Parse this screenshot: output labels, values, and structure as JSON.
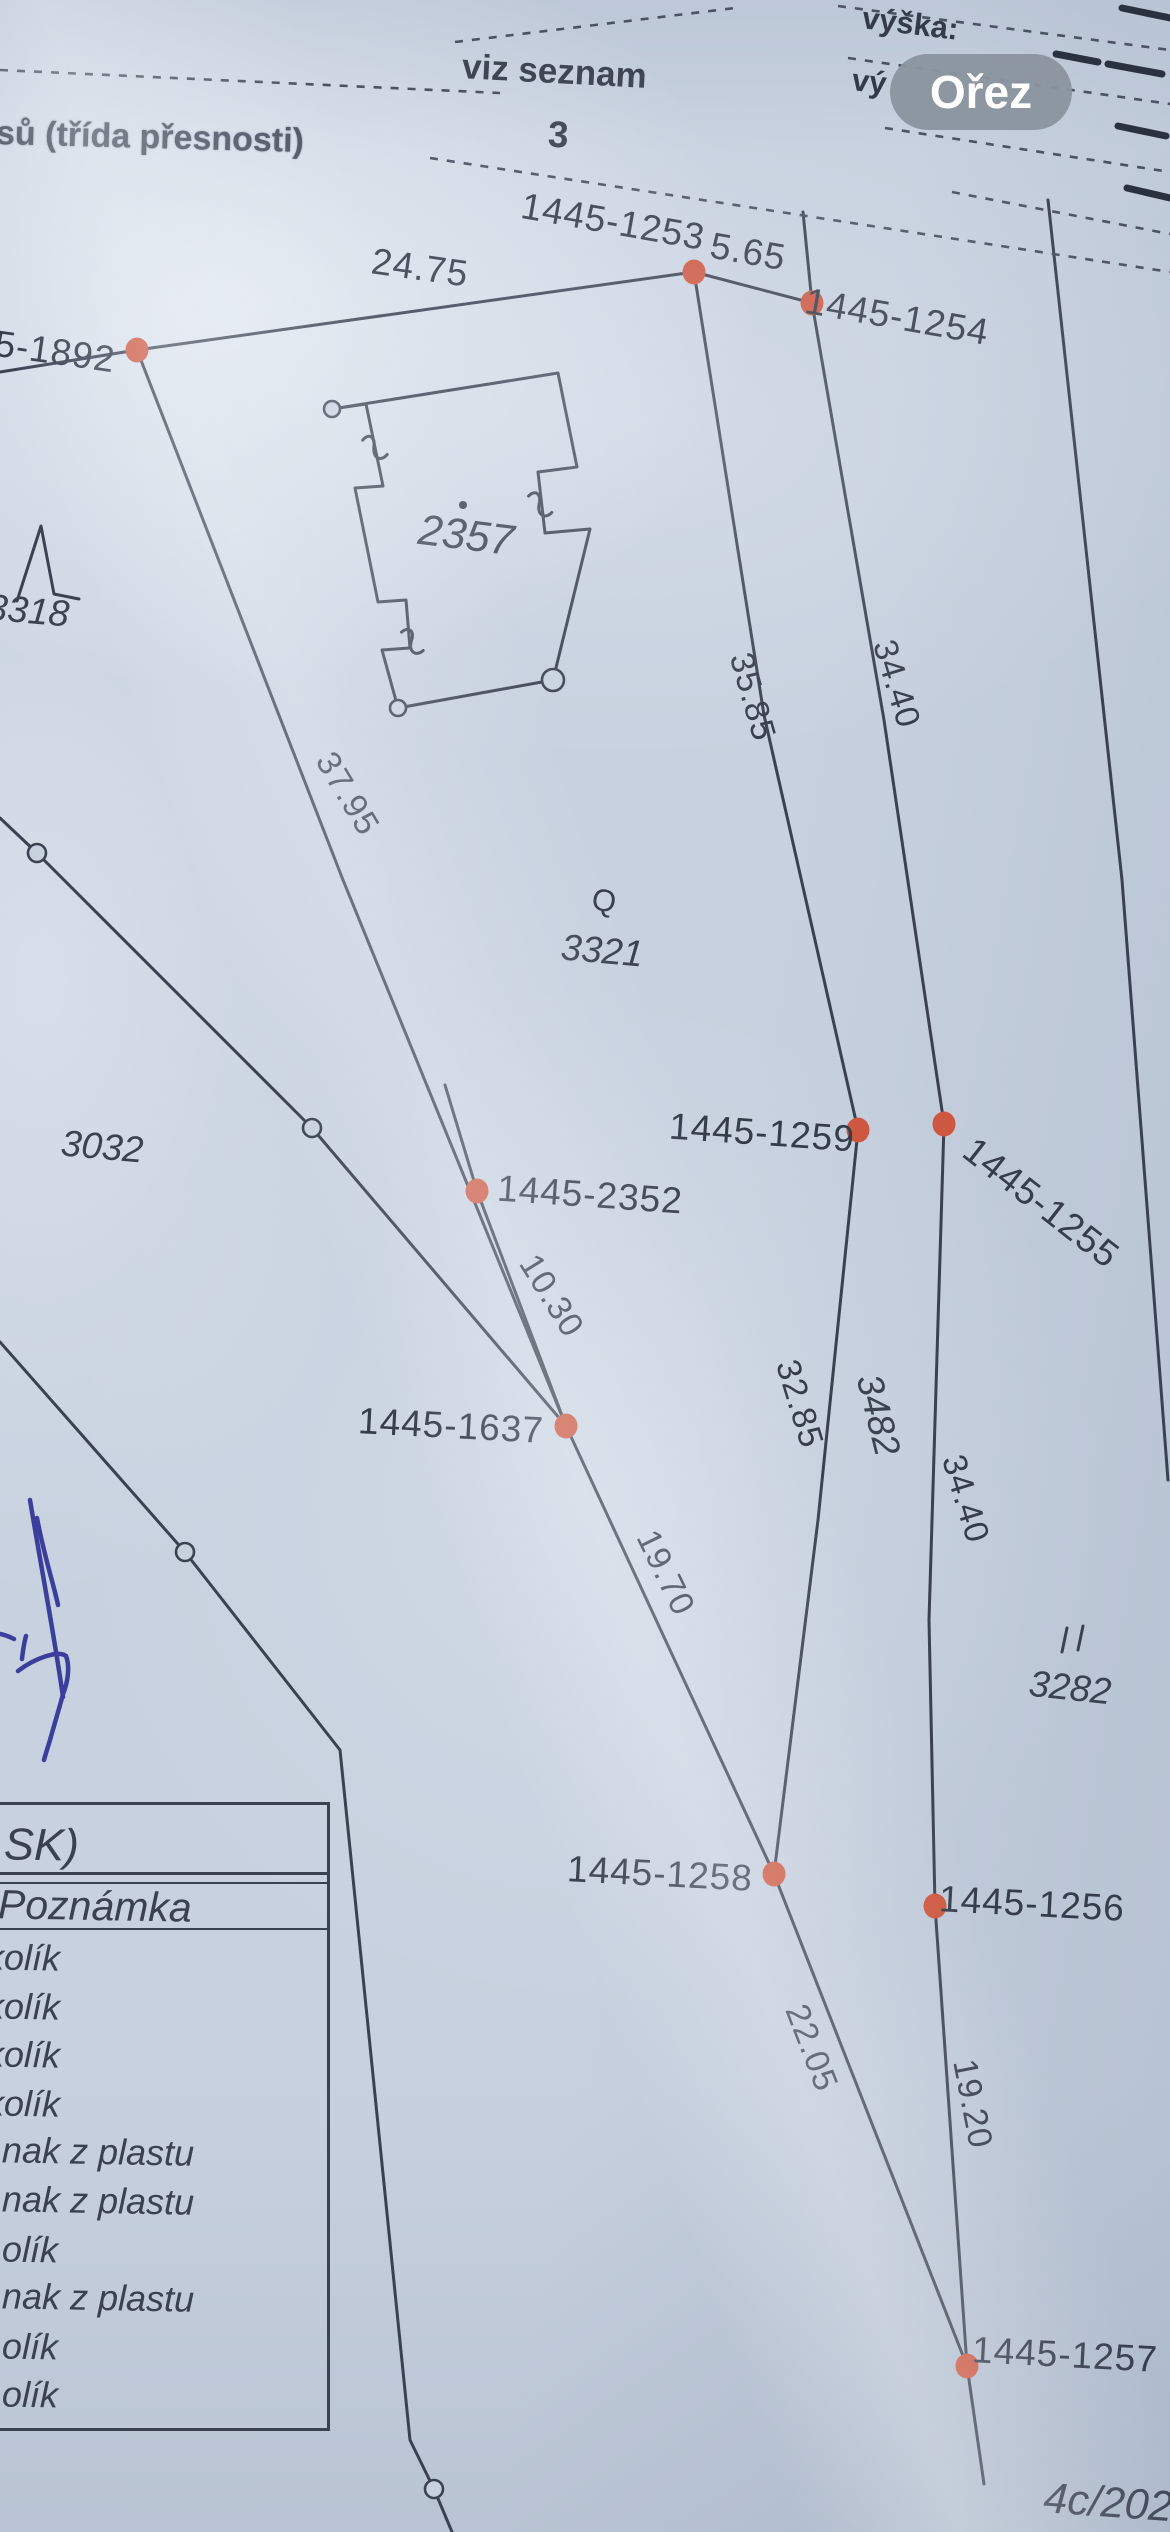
{
  "ui": {
    "crop_button_label": "Ořez"
  },
  "header": {
    "accuracy_note": "sů (třída přesnosti)",
    "see_list": "viz seznam",
    "list_number": "3",
    "height_label": "výška:",
    "height_label_partial": "vý"
  },
  "legend_table": {
    "header_fragment": "SK)",
    "subheader": "Poznámka",
    "rows": [
      "kolík",
      "kolík",
      "kolík",
      "kolík",
      "nak z plastu",
      "nak z plastu",
      "olík",
      "nak z plastu",
      "olík",
      "olík"
    ]
  },
  "colors": {
    "paper": "#c7d1df",
    "ink": "#3a4150",
    "point": "#cd5740",
    "button_bg": "#8a949e",
    "handwriting_ink": "#3c3e9b"
  },
  "map": {
    "points": [
      {
        "id": "1445-1253",
        "x": 694,
        "y": 272
      },
      {
        "id": "1445-1254",
        "x": 812,
        "y": 303
      },
      {
        "id": "1445-1892",
        "x": 137,
        "y": 350
      },
      {
        "id": "1445-1259",
        "x": 858,
        "y": 1130
      },
      {
        "id": "1445-1255",
        "x": 944,
        "y": 1124
      },
      {
        "id": "1445-2352",
        "x": 477,
        "y": 1191
      },
      {
        "id": "1445-1637",
        "x": 566,
        "y": 1426
      },
      {
        "id": "1445-1258",
        "x": 774,
        "y": 1874
      },
      {
        "id": "1445-1256",
        "x": 935,
        "y": 1906
      },
      {
        "id": "1445-1257",
        "x": 967,
        "y": 2366
      }
    ],
    "labels": [
      {
        "text": "1445-1253",
        "x": 613,
        "y": 222,
        "rot": 10,
        "cls": "plain"
      },
      {
        "text": "5.65",
        "x": 748,
        "y": 252,
        "rot": 10,
        "cls": "plain"
      },
      {
        "text": "1445-1254",
        "x": 897,
        "y": 317,
        "rot": 10,
        "cls": "plain"
      },
      {
        "text": "5-1892",
        "x": 55,
        "y": 352,
        "rot": 8,
        "cls": "plain"
      },
      {
        "text": "24.75",
        "x": 420,
        "y": 268,
        "rot": 8,
        "cls": "plain"
      },
      {
        "text": "1445-1259",
        "x": 762,
        "y": 1133,
        "rot": 4,
        "cls": "plain"
      },
      {
        "text": "1445-2352",
        "x": 590,
        "y": 1195,
        "rot": 4,
        "cls": "plain"
      },
      {
        "text": "1445-1637",
        "x": 451,
        "y": 1426,
        "rot": 3,
        "cls": "plain"
      },
      {
        "text": "1445-1258",
        "x": 660,
        "y": 1874,
        "rot": 3,
        "cls": "plain"
      },
      {
        "text": "1445-1256",
        "x": 1032,
        "y": 1904,
        "rot": 3,
        "cls": "plain"
      },
      {
        "text": "1445-1257",
        "x": 1065,
        "y": 2355,
        "rot": 3,
        "cls": "plain"
      },
      {
        "text": "1445-1255",
        "x": 1041,
        "y": 1203,
        "rot": 38,
        "cls": "plain"
      },
      {
        "text": "35.85",
        "x": 752,
        "y": 697,
        "rot": 74,
        "cls": "meas"
      },
      {
        "text": "34.40",
        "x": 896,
        "y": 684,
        "rot": 73,
        "cls": "meas"
      },
      {
        "text": "37.95",
        "x": 347,
        "y": 794,
        "rot": 59,
        "cls": "meas"
      },
      {
        "text": "10.30",
        "x": 551,
        "y": 1296,
        "rot": 58,
        "cls": "meas"
      },
      {
        "text": "32.85",
        "x": 799,
        "y": 1404,
        "rot": 73,
        "cls": "meas"
      },
      {
        "text": "3482",
        "x": 878,
        "y": 1415,
        "rot": 76,
        "cls": "parcel"
      },
      {
        "text": "34.40",
        "x": 965,
        "y": 1499,
        "rot": 73,
        "cls": "meas"
      },
      {
        "text": "19.70",
        "x": 665,
        "y": 1573,
        "rot": 64,
        "cls": "meas"
      },
      {
        "text": "22.05",
        "x": 811,
        "y": 2048,
        "rot": 69,
        "cls": "meas"
      },
      {
        "text": "19.20",
        "x": 972,
        "y": 2104,
        "rot": 79,
        "cls": "meas"
      },
      {
        "text": "2357",
        "x": 466,
        "y": 536,
        "rot": 7,
        "cls": "parcel-lg"
      },
      {
        "text": "3321",
        "x": 602,
        "y": 951,
        "rot": 5,
        "cls": "parcel"
      },
      {
        "text": "3032",
        "x": 102,
        "y": 1147,
        "rot": 5,
        "cls": "parcel"
      },
      {
        "text": "3318",
        "x": 28,
        "y": 611,
        "rot": 5,
        "cls": "parcel"
      },
      {
        "text": "3282",
        "x": 1070,
        "y": 1688,
        "rot": 6,
        "cls": "parcel"
      },
      {
        "text": "4c/2024",
        "x": 1120,
        "y": 2504,
        "rot": 4,
        "cls": "parcel-lg"
      },
      {
        "text": "Q",
        "x": 604,
        "y": 901,
        "rot": 10,
        "cls": "sym"
      }
    ],
    "lines": [
      {
        "pts": [
          [
            0,
            372
          ],
          [
            137,
            350
          ],
          [
            694,
            272
          ]
        ]
      },
      {
        "pts": [
          [
            694,
            272
          ],
          [
            812,
            303
          ]
        ]
      },
      {
        "pts": [
          [
            803,
            212
          ],
          [
            812,
            303
          ]
        ]
      },
      {
        "pts": [
          [
            694,
            272
          ],
          [
            764,
            715
          ],
          [
            858,
            1130
          ]
        ]
      },
      {
        "pts": [
          [
            812,
            303
          ],
          [
            884,
            720
          ],
          [
            944,
            1124
          ]
        ]
      },
      {
        "pts": [
          [
            1048,
            200
          ],
          [
            1122,
            880
          ],
          [
            1168,
            1480
          ]
        ]
      },
      {
        "pts": [
          [
            858,
            1130
          ],
          [
            818,
            1520
          ],
          [
            774,
            1874
          ]
        ]
      },
      {
        "pts": [
          [
            944,
            1124
          ],
          [
            929,
            1620
          ],
          [
            935,
            1906
          ],
          [
            967,
            2366
          ]
        ]
      },
      {
        "pts": [
          [
            137,
            350
          ],
          [
            343,
            880
          ],
          [
            566,
            1426
          ]
        ]
      },
      {
        "pts": [
          [
            445,
            1085
          ],
          [
            477,
            1191
          ],
          [
            566,
            1426
          ]
        ]
      },
      {
        "pts": [
          [
            566,
            1426
          ],
          [
            774,
            1874
          ]
        ]
      },
      {
        "pts": [
          [
            774,
            1874
          ],
          [
            967,
            2366
          ]
        ]
      },
      {
        "pts": [
          [
            967,
            2366
          ],
          [
            984,
            2484
          ]
        ]
      },
      {
        "pts": [
          [
            0,
            818
          ],
          [
            37,
            853
          ],
          [
            312,
            1128
          ],
          [
            566,
            1426
          ]
        ]
      },
      {
        "pts": [
          [
            0,
            1342
          ],
          [
            185,
            1552
          ],
          [
            340,
            1750
          ],
          [
            410,
            2440
          ],
          [
            434,
            2489
          ],
          [
            452,
            2532
          ]
        ]
      }
    ],
    "dashed_lines": [
      {
        "pts": [
          [
            455,
            42
          ],
          [
            735,
            8
          ]
        ]
      },
      {
        "pts": [
          [
            0,
            70
          ],
          [
            500,
            93
          ]
        ]
      },
      {
        "pts": [
          [
            430,
            158
          ],
          [
            1170,
            272
          ]
        ]
      },
      {
        "pts": [
          [
            838,
            6
          ],
          [
            1170,
            50
          ]
        ]
      },
      {
        "pts": [
          [
            848,
            58
          ],
          [
            1170,
            104
          ]
        ]
      },
      {
        "pts": [
          [
            885,
            128
          ],
          [
            1170,
            172
          ]
        ]
      },
      {
        "pts": [
          [
            952,
            192
          ],
          [
            1170,
            234
          ]
        ]
      }
    ],
    "bold_dashes": [
      {
        "pts": [
          [
            1122,
            8
          ],
          [
            1170,
            18
          ]
        ]
      },
      {
        "pts": [
          [
            1056,
            54
          ],
          [
            1098,
            62
          ]
        ]
      },
      {
        "pts": [
          [
            1108,
            64
          ],
          [
            1162,
            74
          ]
        ]
      },
      {
        "pts": [
          [
            1118,
            126
          ],
          [
            1166,
            136
          ]
        ]
      },
      {
        "pts": [
          [
            1127,
            188
          ],
          [
            1170,
            198
          ]
        ]
      }
    ],
    "open_circles": [
      [
        37,
        853
      ],
      [
        312,
        1128
      ],
      [
        185,
        1552
      ],
      [
        434,
        2489
      ]
    ],
    "building": {
      "path": "M332,409 L558,373 L577,467 L538,472 L545,533 L590,529 L553,680 L398,708 L382,650 L410,648 L406,600 L378,602 L355,488 L383,486 L366,404 Z",
      "circles": [
        [
          332,
          409,
          8
        ],
        [
          398,
          708,
          8
        ],
        [
          553,
          680,
          11
        ]
      ],
      "hooks": [
        [
          375,
          450,
          -70
        ],
        [
          540,
          507,
          -65
        ],
        [
          412,
          644,
          -60
        ]
      ],
      "dot": [
        463,
        505
      ]
    },
    "symbols": {
      "lambda_path": "M17,601 L41,526 L54,594 L79,599",
      "double_tick": [
        [
          1062,
          1652,
          1067,
          1628
        ],
        [
          1078,
          1650,
          1083,
          1626
        ]
      ]
    },
    "handwriting": [
      "M30,1500 C40,1560 55,1640 63,1697",
      "M37,1518 C45,1560 54,1585 58,1605",
      "M0,1634 C6,1635 10,1637 14,1639",
      "M22,1659 C23,1650 24,1643 26,1636",
      "M18,1671 C35,1658 58,1650 66,1656 C70,1666 68,1682 63,1694 C60,1706 55,1722 50,1740 C47,1750 45,1756 44,1760"
    ]
  }
}
